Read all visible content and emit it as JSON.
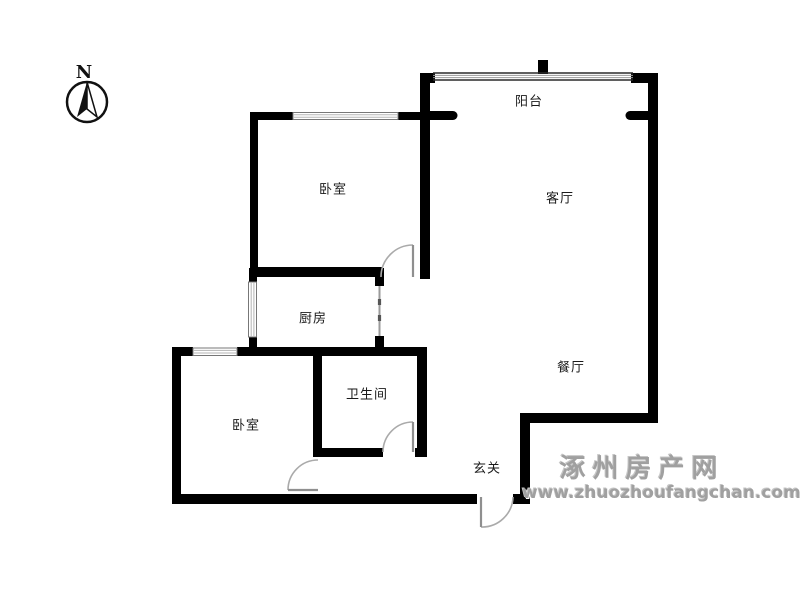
{
  "compass": {
    "label": "N"
  },
  "rooms": [
    {
      "id": "balcony",
      "label": "阳台"
    },
    {
      "id": "bedroom-north",
      "label": "卧室"
    },
    {
      "id": "living-room",
      "label": "客厅"
    },
    {
      "id": "kitchen",
      "label": "厨房"
    },
    {
      "id": "bathroom",
      "label": "卫生间"
    },
    {
      "id": "bedroom-south",
      "label": "卧室"
    },
    {
      "id": "dining-room",
      "label": "餐厅"
    },
    {
      "id": "entry-hall",
      "label": "玄关"
    }
  ],
  "watermark": {
    "site_name": "涿州房产网",
    "site_url": "www.zhuozhoufangchan.com",
    "color": "#a0a0a0"
  },
  "colors": {
    "wall": "#000000",
    "window_frame": "#777777",
    "window_pane": "#b5b5b5",
    "door_leaf": "#8f8f8f",
    "door_arc": "#aaaaaa",
    "label": "#1a1a1a",
    "background": "#ffffff"
  }
}
